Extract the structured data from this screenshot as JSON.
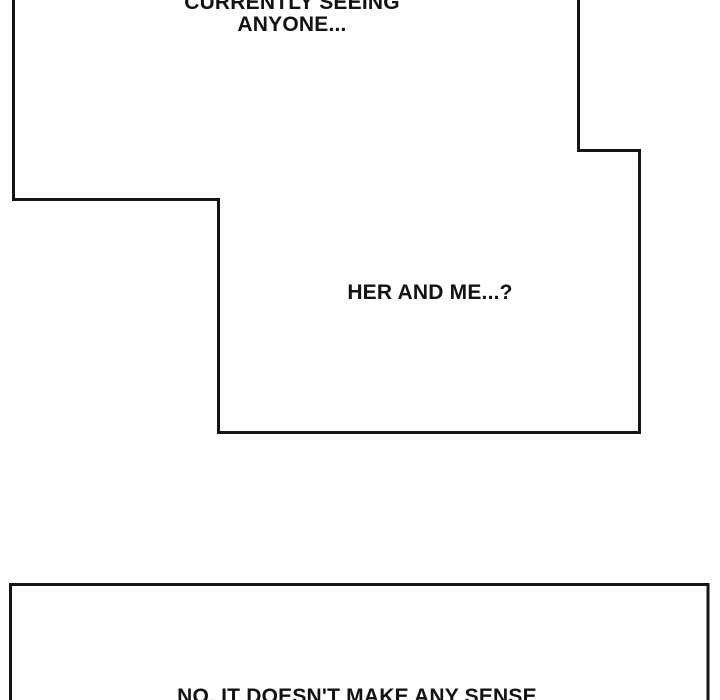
{
  "page": {
    "background_color": "#ffffff",
    "ink_color": "#141414"
  },
  "panels": {
    "top_panel": {
      "speech_top": {
        "line1": "CURRENTLY SEEING",
        "line2": "ANYONE..."
      },
      "speech_mid": {
        "text": "HER AND ME...?"
      }
    },
    "bottom_panel": {
      "speech": {
        "text": "NO, IT DOESN'T MAKE ANY SENSE"
      }
    }
  }
}
